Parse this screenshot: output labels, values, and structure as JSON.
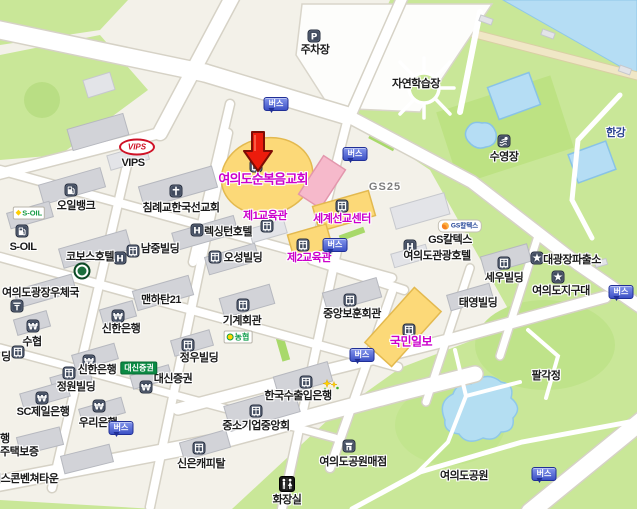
{
  "map": {
    "bus_label": "버스",
    "colors": {
      "poi_magenta": "#cc00cc",
      "bus_blue": "#3c51c5",
      "marker_red": "#ec1c0c",
      "water_blue": "#b5ddf4",
      "park_green": "#c9e798"
    },
    "marker": {
      "name": "selected-location-marker",
      "x": 241,
      "y": 129,
      "tip_x": 258,
      "tip_y": 171
    },
    "bus_stops": [
      {
        "x": 276,
        "y": 104
      },
      {
        "x": 355,
        "y": 154
      },
      {
        "x": 335,
        "y": 245
      },
      {
        "x": 362,
        "y": 355
      },
      {
        "x": 121,
        "y": 428
      },
      {
        "x": 621,
        "y": 292
      },
      {
        "x": 544,
        "y": 474
      }
    ],
    "logos": [
      {
        "name": "vips",
        "kind": "vips",
        "text": "VIPS",
        "x": 137,
        "y": 147
      },
      {
        "name": "s-oil",
        "kind": "soil",
        "text": "S-OIL",
        "x": 29,
        "y": 213
      },
      {
        "name": "gs-caltex",
        "kind": "gsc",
        "text": "GS칼텍스",
        "x": 460,
        "y": 226
      },
      {
        "name": "daishin-securities",
        "kind": "daishin",
        "text": "대신증권",
        "x": 139,
        "y": 368
      },
      {
        "name": "nonghyup",
        "kind": "nh",
        "text": "농협",
        "x": 238,
        "y": 337
      },
      {
        "name": "kobos-hotel",
        "kind": "kobos",
        "text": "",
        "x": 82,
        "y": 271
      }
    ],
    "pois": [
      {
        "name": "parking-lot",
        "label": "주차장",
        "x": 315,
        "y": 49,
        "cls": "",
        "ia": true,
        "icon": {
          "kind": "parking",
          "x": 314,
          "y": 36
        }
      },
      {
        "name": "nature-learning-center",
        "label": "자연학습장",
        "x": 416,
        "y": 83,
        "cls": "",
        "ia": false
      },
      {
        "name": "swimming-pool",
        "label": "수영장",
        "x": 504,
        "y": 156,
        "cls": "",
        "ia": true,
        "icon": {
          "kind": "swim",
          "x": 504,
          "y": 141
        }
      },
      {
        "name": "han-river",
        "label": "한강",
        "x": 606,
        "y": 132,
        "cls": "k-navy",
        "anchor": "left",
        "ia": false
      },
      {
        "name": "vips-label",
        "label": "VIPS",
        "x": 133,
        "y": 163,
        "cls": "",
        "ia": true
      },
      {
        "name": "oilbank",
        "label": "오일뱅크",
        "x": 76,
        "y": 205,
        "cls": "",
        "ia": true,
        "icon": {
          "kind": "gas",
          "x": 71,
          "y": 190
        }
      },
      {
        "name": "s-oil-label",
        "label": "S-OIL",
        "x": 23,
        "y": 247,
        "cls": "",
        "ia": true,
        "icon": {
          "kind": "gas",
          "x": 22,
          "y": 231
        }
      },
      {
        "name": "baptist-korea-mission",
        "label": "침례교한국선교회",
        "x": 181,
        "y": 207,
        "cls": "",
        "ia": true,
        "icon": {
          "kind": "church",
          "x": 176,
          "y": 191
        }
      },
      {
        "name": "lexington-hotel",
        "label": "렉싱턴호텔",
        "x": 228,
        "y": 231,
        "cls": "",
        "ia": true,
        "icon": {
          "kind": "hotel",
          "x": 197,
          "y": 230
        }
      },
      {
        "name": "kobos-hotel-label",
        "label": "코보스호텔",
        "x": 90,
        "y": 256,
        "cls": "",
        "ia": true
      },
      {
        "name": "namjung-bldg",
        "label": "남중빌딩",
        "x": 160,
        "y": 248,
        "cls": "",
        "ia": true,
        "icon": {
          "kind": "building",
          "x": 133,
          "y": 251
        }
      },
      {
        "name": "namjung-hotel-icon",
        "label": null,
        "x": 0,
        "y": 0,
        "cls": "",
        "ia": true,
        "icon": {
          "kind": "hotel",
          "x": 120,
          "y": 258
        }
      },
      {
        "name": "osung-bldg",
        "label": "오성빌딩",
        "x": 243,
        "y": 257,
        "cls": "",
        "ia": true,
        "icon": {
          "kind": "building",
          "x": 215,
          "y": 257
        }
      },
      {
        "name": "yeouido-full-gospel-church",
        "label": "여의도순복음교회",
        "x": 263,
        "y": 178,
        "cls": "k-magenta k-big",
        "ia": true,
        "icon": {
          "kind": "building",
          "x": 256,
          "y": 166
        }
      },
      {
        "name": "edu-hall-1",
        "label": "제1교육관",
        "x": 265,
        "y": 215,
        "cls": "k-magenta",
        "ia": true,
        "icon": {
          "kind": "building",
          "x": 267,
          "y": 226
        }
      },
      {
        "name": "world-mission-center",
        "label": "세계선교센터",
        "x": 342,
        "y": 218,
        "cls": "k-magenta",
        "ia": true,
        "icon": {
          "kind": "building",
          "x": 342,
          "y": 206
        }
      },
      {
        "name": "edu-hall-2",
        "label": "제2교육관",
        "x": 309,
        "y": 257,
        "cls": "k-magenta",
        "ia": true,
        "icon": {
          "kind": "building",
          "x": 303,
          "y": 245
        }
      },
      {
        "name": "gs25",
        "label": "GS25",
        "x": 385,
        "y": 187,
        "cls": "k-gray",
        "ia": true
      },
      {
        "name": "gs-caltex-label",
        "label": "GS칼텍스",
        "x": 450,
        "y": 239,
        "cls": "",
        "ia": true
      },
      {
        "name": "yeouido-tourist-hotel",
        "label": "여의도관광호텔",
        "x": 437,
        "y": 255,
        "cls": "",
        "ia": true,
        "icon": {
          "kind": "hotel",
          "x": 410,
          "y": 246
        }
      },
      {
        "name": "sewoo-bldg",
        "label": "세우빌딩",
        "x": 504,
        "y": 277,
        "cls": "",
        "ia": true,
        "icon": {
          "kind": "building",
          "x": 504,
          "y": 263
        }
      },
      {
        "name": "daegwangjang-police-box",
        "label": "대광장파출소",
        "x": 572,
        "y": 259,
        "cls": "",
        "ia": true,
        "icon": {
          "kind": "police",
          "x": 537,
          "y": 258
        }
      },
      {
        "name": "yeouido-patrol-unit",
        "label": "여의도지구대",
        "x": 561,
        "y": 290,
        "cls": "",
        "ia": true,
        "icon": {
          "kind": "police",
          "x": 558,
          "y": 277
        }
      },
      {
        "name": "taeyoung-bldg",
        "label": "태영빌딩",
        "x": 478,
        "y": 302,
        "cls": "",
        "ia": true
      },
      {
        "name": "central-veterans-hall",
        "label": "중앙보훈회관",
        "x": 352,
        "y": 313,
        "cls": "",
        "ia": true,
        "icon": {
          "kind": "building",
          "x": 350,
          "y": 300
        }
      },
      {
        "name": "kukmin-ilbo",
        "label": "국민일보",
        "x": 411,
        "y": 341,
        "cls": "k-magenta k-mid",
        "ia": true,
        "icon": {
          "kind": "building",
          "x": 409,
          "y": 330
        }
      },
      {
        "name": "yeouido-post-office",
        "label": "여의도광장우체국",
        "x": 2,
        "y": 292,
        "cls": "",
        "anchor": "left",
        "ia": true,
        "icon": {
          "kind": "post",
          "x": 17,
          "y": 306
        }
      },
      {
        "name": "manhattan21",
        "label": "맨하탄21",
        "x": 161,
        "y": 299,
        "cls": "",
        "ia": true
      },
      {
        "name": "shinhan-bank-1",
        "label": "신한은행",
        "x": 121,
        "y": 328,
        "cls": "",
        "ia": true,
        "icon": {
          "kind": "bank",
          "x": 118,
          "y": 316
        }
      },
      {
        "name": "suhyup",
        "label": "수협",
        "x": 32,
        "y": 341,
        "cls": "",
        "ia": true,
        "icon": {
          "kind": "bank",
          "x": 33,
          "y": 326
        }
      },
      {
        "name": "partial-bldg",
        "label": "딩",
        "x": 1,
        "y": 356,
        "cls": "",
        "anchor": "left",
        "ia": true,
        "icon": {
          "kind": "building",
          "x": 18,
          "y": 352
        }
      },
      {
        "name": "jungwoo-bldg",
        "label": "정우빌딩",
        "x": 199,
        "y": 357,
        "cls": "",
        "ia": true,
        "icon": {
          "kind": "building",
          "x": 188,
          "y": 345
        }
      },
      {
        "name": "shinhan-bank-2",
        "label": "신한은행",
        "x": 97,
        "y": 369,
        "cls": "",
        "ia": true,
        "icon": {
          "kind": "bank",
          "x": 89,
          "y": 361
        }
      },
      {
        "name": "jungwon-bldg",
        "label": "정원빌딩",
        "x": 76,
        "y": 386,
        "cls": "",
        "ia": true,
        "icon": {
          "kind": "building",
          "x": 69,
          "y": 373
        }
      },
      {
        "name": "daishin-securities-label",
        "label": "대신증권",
        "x": 173,
        "y": 378,
        "cls": "",
        "ia": true,
        "icon": {
          "kind": "bank",
          "x": 146,
          "y": 387
        }
      },
      {
        "name": "sc-first-bank",
        "label": "SC제일은행",
        "x": 43,
        "y": 411,
        "cls": "",
        "ia": true,
        "icon": {
          "kind": "bank",
          "x": 42,
          "y": 398
        }
      },
      {
        "name": "woori-bank",
        "label": "우리은행",
        "x": 98,
        "y": 422,
        "cls": "",
        "ia": true,
        "icon": {
          "kind": "bank",
          "x": 99,
          "y": 406
        }
      },
      {
        "name": "partial-haeng",
        "label": "행",
        "x": 0,
        "y": 438,
        "cls": "",
        "anchor": "left",
        "ia": true
      },
      {
        "name": "partial-housing-guarantee",
        "label": "주택보증",
        "x": 0,
        "y": 451,
        "cls": "",
        "anchor": "left",
        "ia": true
      },
      {
        "name": "excon-venture-town",
        "label": "엑스콘벤쳐타운",
        "x": -9,
        "y": 478,
        "cls": "",
        "anchor": "left",
        "ia": true
      },
      {
        "name": "shinn-capital",
        "label": "신은캐피탈",
        "x": 201,
        "y": 463,
        "cls": "",
        "ia": true,
        "icon": {
          "kind": "building",
          "x": 199,
          "y": 448
        }
      },
      {
        "name": "korea-exim-bank",
        "label": "한국수출입은행",
        "x": 298,
        "y": 395,
        "cls": "",
        "ia": true,
        "icon": {
          "kind": "building",
          "x": 306,
          "y": 382
        }
      },
      {
        "name": "sme-central-assoc",
        "label": "중소기업중앙회",
        "x": 256,
        "y": 425,
        "cls": "",
        "ia": true,
        "icon": {
          "kind": "building",
          "x": 256,
          "y": 411
        }
      },
      {
        "name": "yeouido-park-store",
        "label": "여의도공원매점",
        "x": 353,
        "y": 461,
        "cls": "",
        "ia": true,
        "icon": {
          "kind": "shop",
          "x": 349,
          "y": 446
        }
      },
      {
        "name": "restroom",
        "label": "화장실",
        "x": 287,
        "y": 499,
        "cls": "",
        "ia": true,
        "icon": {
          "kind": "toilet",
          "x": 287,
          "y": 484
        }
      },
      {
        "name": "machinery-hall",
        "label": "기계회관",
        "x": 242,
        "y": 320,
        "cls": "",
        "ia": true,
        "icon": {
          "kind": "building",
          "x": 243,
          "y": 305
        }
      },
      {
        "name": "palgakjeong",
        "label": "팔각정",
        "x": 546,
        "y": 375,
        "cls": "",
        "ia": false
      },
      {
        "name": "yeouido-park",
        "label": "여의도공원",
        "x": 464,
        "y": 475,
        "cls": "",
        "ia": false
      },
      {
        "name": "flower-deco",
        "label": null,
        "x": 0,
        "y": 0,
        "cls": "",
        "ia": false,
        "icon": {
          "kind": "stars",
          "x": 331,
          "y": 386
        }
      }
    ]
  }
}
